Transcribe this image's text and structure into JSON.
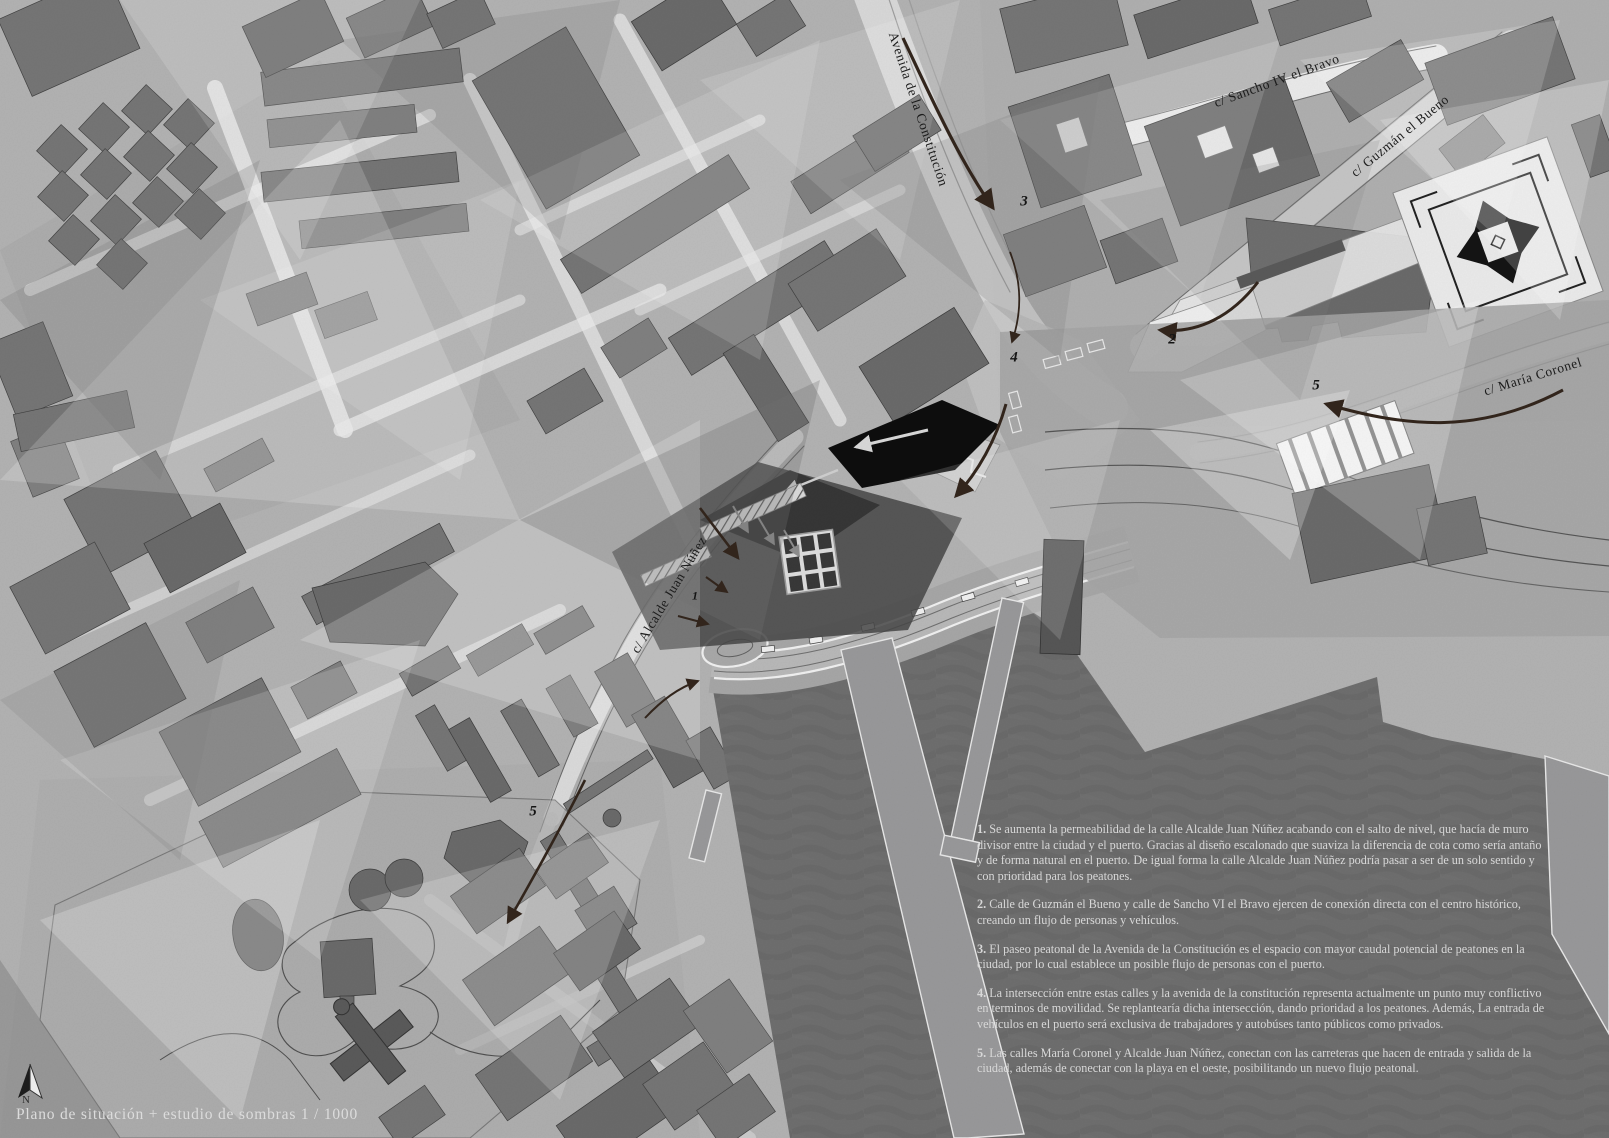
{
  "document": {
    "title": "Plano de situación + estudio de sombras 1 / 1000",
    "north_label": "N"
  },
  "streets": {
    "constitucion": "Avenida de la Constitución",
    "sancho": "c/ Sancho IV el Bravo",
    "guzman": "c/ Guzmán el Bueno",
    "maria_coronel": "c/ María Coronel",
    "alcalde": "c/ Alcalde Juan Núñez"
  },
  "markers": {
    "m1": "1",
    "m2": "2",
    "m3": "3",
    "m4": "4",
    "m5_street": "5",
    "m5_park": "5"
  },
  "notes": [
    {
      "num": "1.",
      "text": "Se aumenta la permeabilidad de la calle Alcalde Juan Núñez acabando con el salto de nivel, que hacía de muro divisor entre la ciudad y el puerto. Gracias al diseño escalonado que suaviza la diferencia de cota como sería antaño y de forma natural en el puerto. De igual forma la calle Alcalde Juan Núñez podría pasar a ser de un solo sentido y con prioridad para los peatones."
    },
    {
      "num": "2.",
      "text": "Calle de Guzmán el Bueno y calle de Sancho VI el Bravo ejercen de conexión directa con el centro histórico, creando un flujo de personas y vehículos."
    },
    {
      "num": "3.",
      "text": "El paseo peatonal de la Avenida de la Constitución es el espacio con mayor caudal potencial de peatones en la ciudad, por lo cual establece un posible flujo de personas con el puerto."
    },
    {
      "num": "4.",
      "text": "La intersección entre estas calles y la avenida de la constitución representa actualmente un punto muy conflictivo en terminos de movilidad. Se replantearía dicha intersección, dando prioridad a los peatones. Además, La entrada de vehículos en el puerto será exclusiva de trabajadores y autobúses tanto públicos como privados."
    },
    {
      "num": "5.",
      "text": "Las calles María Coronel y Alcalde Juan Núñez, conectan con las carreteras que hacen de entrada y salida de la ciudad, además de conectar con la playa en el oeste, posibilitando un nuevo flujo peatonal."
    }
  ],
  "colors": {
    "arrow_ink": "#32251c",
    "water": "#6e6e6e",
    "note_text": "#d8d8d8",
    "label_ink": "#1c1c1c"
  }
}
